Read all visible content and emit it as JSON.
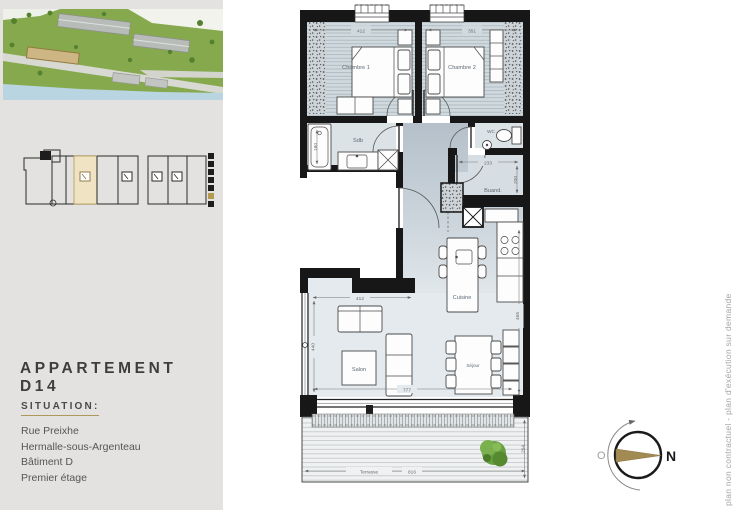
{
  "sidebar": {
    "title": "APPARTEMENT D14",
    "situation_label": "SITUATION:",
    "address_lines": [
      "Rue Preixhe",
      "Hermalle-sous-Argenteau",
      "Bâtiment D",
      "Premier étage"
    ]
  },
  "plan": {
    "rooms": {
      "chambre1": "Chambre 1",
      "chambre2": "Chambre 2",
      "sdb": "Sdb",
      "wc": "WC",
      "buanderie": "Buand.",
      "cuisine": "Cuisine",
      "salon": "Salon",
      "sejour": "Séjour",
      "terrasse": "Terrasse"
    },
    "dims": {
      "chambre1_width": "412",
      "chambre2_width": "351",
      "sdb_depth": "180",
      "buanderie_width": "233",
      "buanderie_depth": "200",
      "salon_width": "412",
      "living_left_height": "440",
      "living_bottom_width": "777",
      "cuisine_right_height": "465",
      "terrasse_width": "816",
      "terrasse_depth": "264"
    }
  },
  "compass": {
    "north": "N",
    "west": "O"
  },
  "footnote": "plan non contractuel - plan d'exécution sur demande",
  "colors": {
    "accent_gold": "#b0975a",
    "wall": "#171717",
    "sidebar_bg": "#e3e2e0",
    "site_green": "#86a94d"
  }
}
